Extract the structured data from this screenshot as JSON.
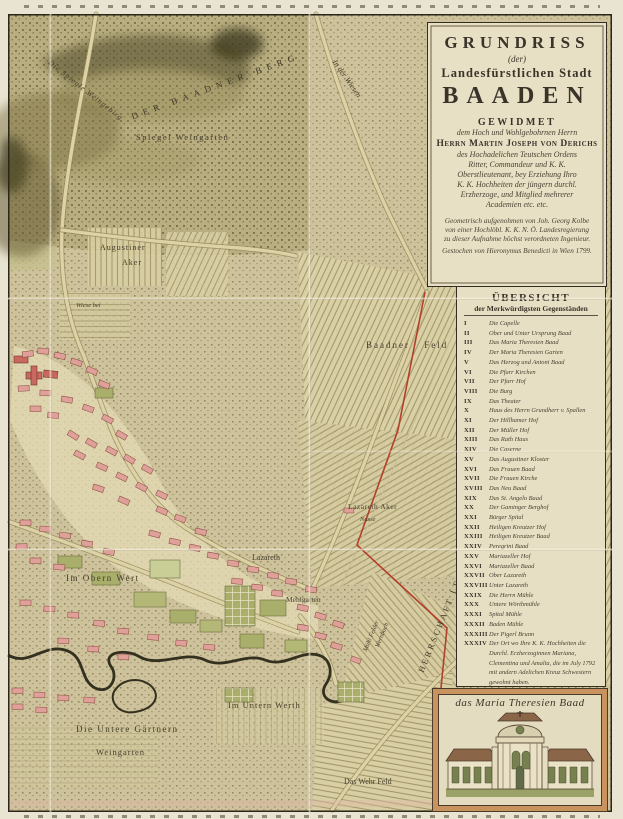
{
  "colors": {
    "paper": "#e9e3d0",
    "panel": "#e8e0c4",
    "ink": "#3a332a",
    "map_base": "#cdc29a",
    "building_pink": "#dfa099",
    "boundary_red": "#b2402a",
    "garden_green": "#a9ae6a"
  },
  "cartouche": {
    "title": "GRUNDRISS",
    "title_der": "(der)",
    "subtitle": "Landesfürstlichen Stadt",
    "city": "BAADEN",
    "dedication_heading": "GEWIDMET",
    "dedication_line1": "dem Hoch und Wohlgebohrnen Herrn",
    "dedicatee": "Herrn Martin Joseph von Derichs",
    "dedication_lines": [
      "des Hochadelichen Teutschen Ordens",
      "Ritter, Commandeur und K. K.",
      "Oberstlieutenant, bey Erziehung Ihro",
      "K. K. Hochheiten der jüngern durchl.",
      "Erzherzoge, und Mitglied mehrerer",
      "Academien etc. etc."
    ],
    "surveyor_lines": [
      "Geometrisch aufgenohmen von Joh. Georg Kolbe",
      "von einer Hochlöbl. K. K. N. Ö. Landesregierung",
      "zu dieser Aufnahme höchst verordneten Ingenieur."
    ],
    "engraver_line": "Gestochen von Hieronymus Benedicti in Wien 1799."
  },
  "legend": {
    "title": "ÜBERSICHT",
    "subtitle": "der Merkwürdigsten Gegenständen",
    "items": [
      {
        "num": "I",
        "label": "Die Capelle"
      },
      {
        "num": "II",
        "label": "Ober und Unter Ursprung Baad"
      },
      {
        "num": "III",
        "label": "Das Maria Theresien Baad"
      },
      {
        "num": "IV",
        "label": "Der Maria Theresien Garten"
      },
      {
        "num": "V",
        "label": "Das Herzog und Antoni Baad"
      },
      {
        "num": "VI",
        "label": "Die Pfarr Kirchen"
      },
      {
        "num": "VII",
        "label": "Der Pfarr Hof"
      },
      {
        "num": "VIII",
        "label": "Die Burg"
      },
      {
        "num": "IX",
        "label": "Das Theater"
      },
      {
        "num": "X",
        "label": "Haus des Herrn Grundherr v. Spallen"
      },
      {
        "num": "XI",
        "label": "Der Hillhamer Hof"
      },
      {
        "num": "XII",
        "label": "Der Müller Hof"
      },
      {
        "num": "XIII",
        "label": "Das Rath Haus"
      },
      {
        "num": "XIV",
        "label": "Die Caserne"
      },
      {
        "num": "XV",
        "label": "Das Augustiner Kloster"
      },
      {
        "num": "XVI",
        "label": "Das Frauen Baad"
      },
      {
        "num": "XVII",
        "label": "Die Frauen Kirche"
      },
      {
        "num": "XVIII",
        "label": "Das Neu Baad"
      },
      {
        "num": "XIX",
        "label": "Das St. Angelo Baad"
      },
      {
        "num": "XX",
        "label": "Der Gaminger Berghof"
      },
      {
        "num": "XXI",
        "label": "Bürger Spital"
      },
      {
        "num": "XXII",
        "label": "Heiligen Kreutzer Hof"
      },
      {
        "num": "XXIII",
        "label": "Heiligen Kreutzer Baad"
      },
      {
        "num": "XXIV",
        "label": "Peregrini Baad"
      },
      {
        "num": "XXV",
        "label": "Mariazeller Hof"
      },
      {
        "num": "XXVI",
        "label": "Mariazeller Baad"
      },
      {
        "num": "XXVII",
        "label": "Ober Lazareth"
      },
      {
        "num": "XXVIII",
        "label": "Unter Lazareth"
      },
      {
        "num": "XXIX",
        "label": "Die Herrn Mühle"
      },
      {
        "num": "XXX",
        "label": "Untere Wörthmühle"
      },
      {
        "num": "XXXI",
        "label": "Spital Mühle"
      },
      {
        "num": "XXXII",
        "label": "Baden Mühle"
      },
      {
        "num": "XXXIII",
        "label": "Der Pigerl Brunn"
      },
      {
        "num": "XXXIV",
        "label": "Der Ort wo Ihre K. K. Hochheiten die Durchl. Erzherzoginnen Mariana, Clementina und Amalia, die im July 1792 mit andern Adelichen Kreuz Schwestern gewohnt haben."
      }
    ]
  },
  "vignette": {
    "caption": "das Maria Theresien Baad"
  },
  "map_labels": [
    {
      "text": "Die Spiegle Weingebirg",
      "x": 52,
      "y": 58,
      "rot": 38,
      "size": 7.5,
      "ls": 1,
      "cls": "lbl-it"
    },
    {
      "text": "DER BAADNER BERG",
      "x": 130,
      "y": 112,
      "rot": -20,
      "size": 9,
      "ls": 5.5,
      "cls": "lbl-caps"
    },
    {
      "text": "Spiegel Weingarten",
      "x": 136,
      "y": 132,
      "size": 8.5,
      "ls": 1.5
    },
    {
      "text": "In der Wiesen",
      "x": 338,
      "y": 58,
      "rot": 55,
      "size": 8,
      "cls": "lbl-it"
    },
    {
      "text": "Augustiner",
      "x": 100,
      "y": 243,
      "size": 8,
      "ls": 1
    },
    {
      "text": "Aker",
      "x": 122,
      "y": 258,
      "size": 8,
      "ls": 1
    },
    {
      "text": "Wiese bei",
      "x": 76,
      "y": 302,
      "size": 6.5,
      "cls": "lbl-it"
    },
    {
      "text": "Baadner Feld",
      "x": 366,
      "y": 340,
      "size": 9,
      "ls": 2,
      "cls": "lbl-ws"
    },
    {
      "text": "Lazareth Aker",
      "x": 348,
      "y": 502,
      "size": 7.5,
      "ls": 0.5
    },
    {
      "text": "Nasse",
      "x": 360,
      "y": 516,
      "size": 6.5,
      "cls": "lbl-it"
    },
    {
      "text": "Lazareth",
      "x": 252,
      "y": 553,
      "size": 8
    },
    {
      "text": "Im Obern Wert",
      "x": 66,
      "y": 573,
      "size": 9,
      "ls": 1.5
    },
    {
      "text": "Mehlgarten",
      "x": 286,
      "y": 595,
      "size": 7.5
    },
    {
      "text": "Mühl Felder",
      "x": 362,
      "y": 650,
      "rot": -68,
      "size": 6.5,
      "cls": "lbl-it"
    },
    {
      "text": "Wernbach",
      "x": 374,
      "y": 646,
      "rot": -68,
      "size": 6.5,
      "cls": "lbl-it"
    },
    {
      "text": "HERRSCHAFT LEESDORF",
      "x": 416,
      "y": 670,
      "rot": -68,
      "size": 8.5,
      "ls": 2.5,
      "cls": "lbl-caps"
    },
    {
      "text": "Im Untern Werth",
      "x": 228,
      "y": 700,
      "size": 8.5,
      "ls": 1
    },
    {
      "text": "Die Untere Gärtnern",
      "x": 76,
      "y": 724,
      "size": 9,
      "ls": 1.5
    },
    {
      "text": "Weingarten",
      "x": 96,
      "y": 747,
      "size": 8.5,
      "ls": 1
    },
    {
      "text": "Das Wehr Feld",
      "x": 344,
      "y": 777,
      "size": 8
    }
  ]
}
